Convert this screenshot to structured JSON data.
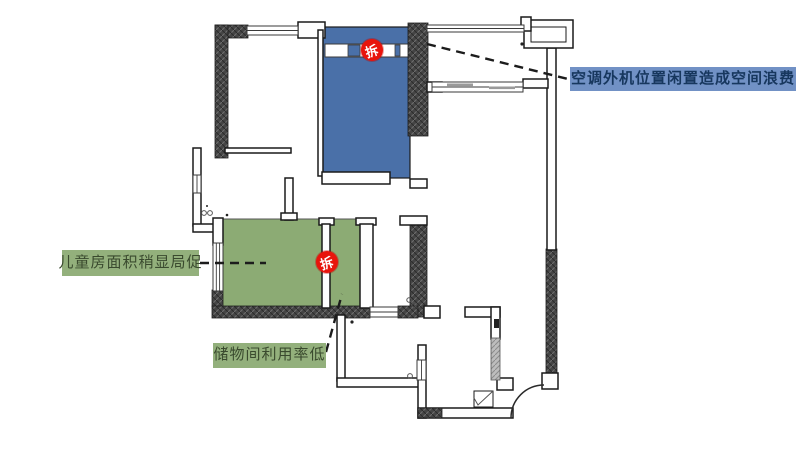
{
  "annotations": {
    "ac_waste": {
      "text": "空调外机位置闲置造成空间浪费"
    },
    "kids_room": {
      "text": "儿童房面积稍显局促"
    },
    "storage": {
      "text": "储物间利用率低"
    }
  },
  "badges": {
    "demolish_label": "拆"
  },
  "colors": {
    "room-blue": "#4a70a8",
    "room-green": "#8cab74",
    "label-blue-bg": "#7191c5",
    "label-blue-ink": "#17375e",
    "label-green-bg": "#93b07c",
    "label-green-ink": "#3a4a2e",
    "badge-red": "#e8140c"
  }
}
